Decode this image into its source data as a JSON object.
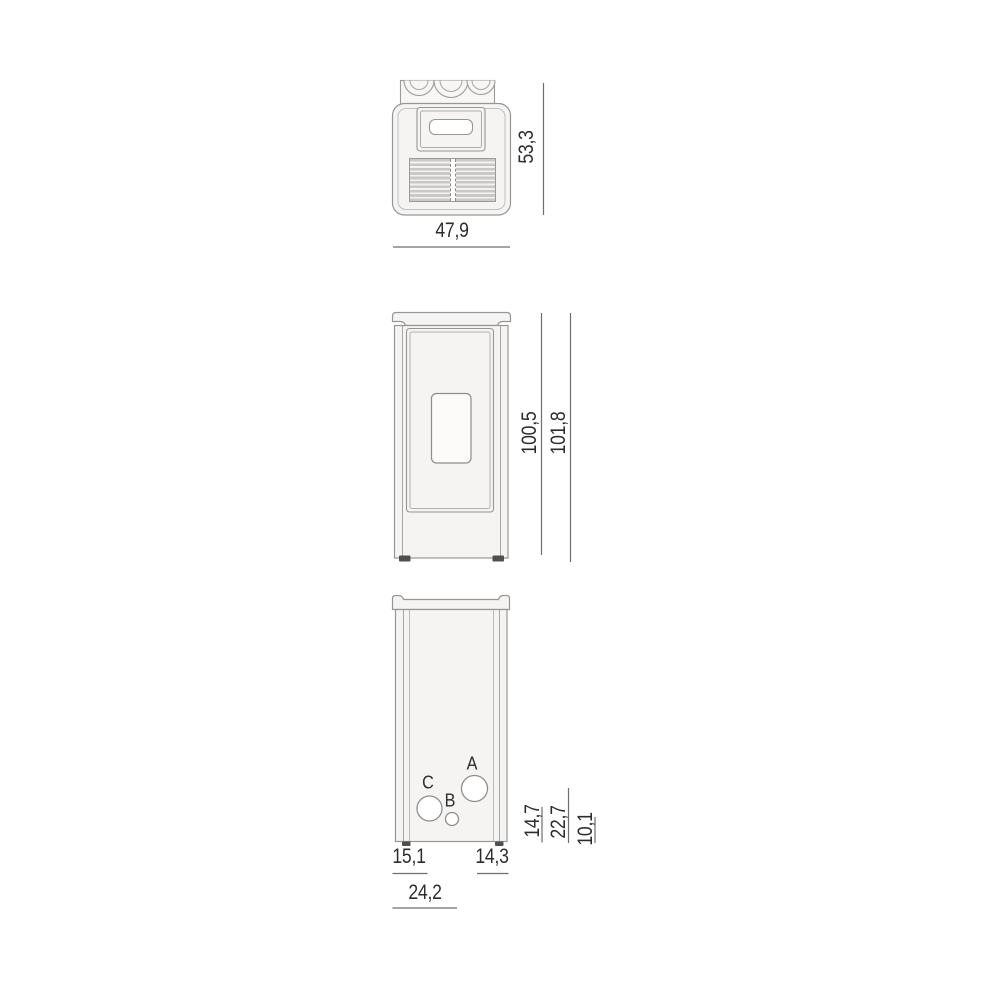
{
  "top_view": {
    "width": "47,9",
    "depth": "53,3"
  },
  "front_view": {
    "body_height": "100,5",
    "total_height": "101,8"
  },
  "rear_view": {
    "ports": {
      "a": "A",
      "b": "B",
      "c": "C"
    },
    "heights": {
      "c": "14,7",
      "a": "22,7",
      "b": "10,1"
    },
    "offsets": {
      "left_to_c": "15,1",
      "a_to_right": "14,3",
      "left_to_b": "24,2"
    }
  },
  "colors": {
    "body_fill": "#f5f4f2",
    "outline": "#969696",
    "inner_line": "#aeaca9",
    "dim_line": "#6e6e6e",
    "text": "#2d2d2d",
    "grille_bar": "#c9c8c6",
    "foot": "#4f4f4f",
    "port_fill": "#ffffff"
  }
}
